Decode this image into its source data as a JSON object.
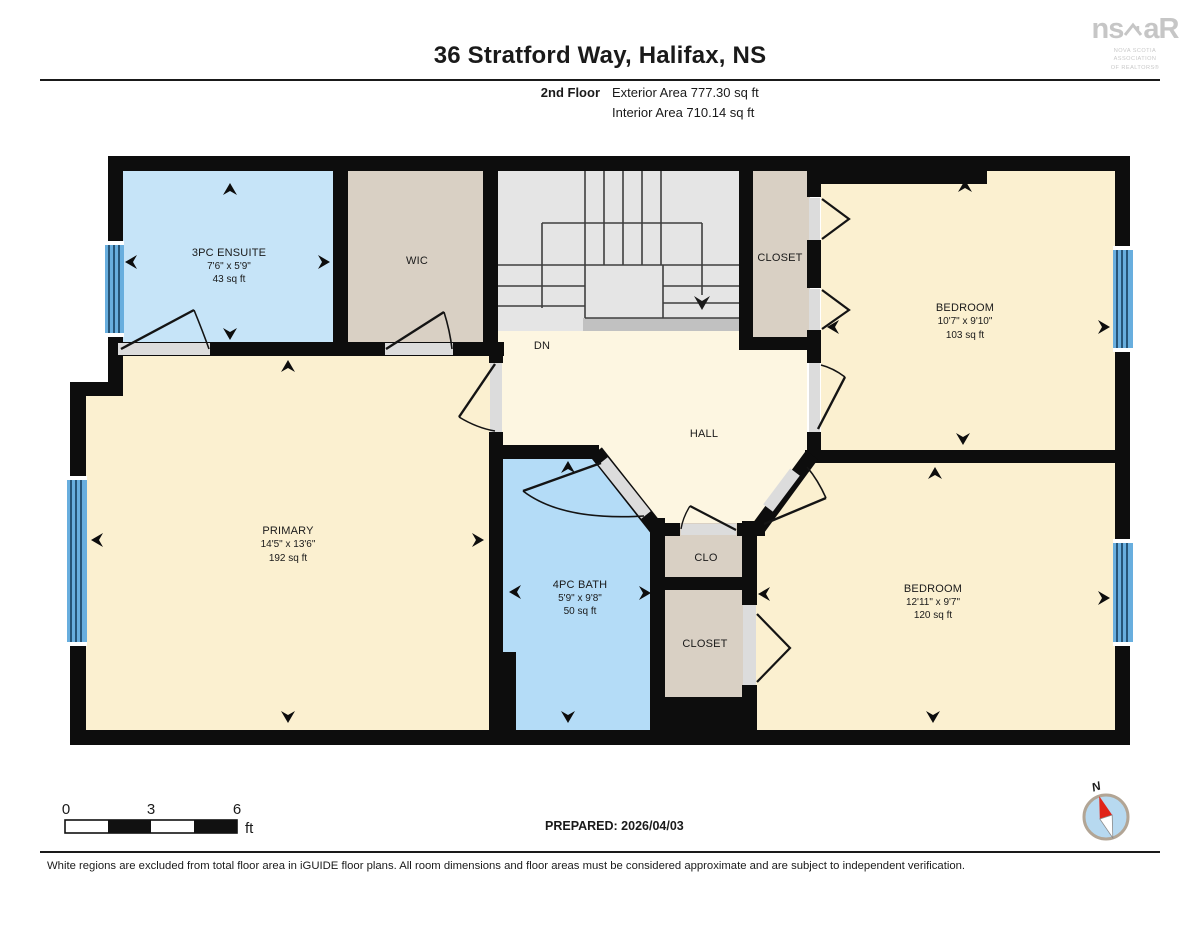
{
  "header": {
    "title": "36 Stratford Way, Halifax, NS",
    "floor_label": "2nd Floor",
    "exterior_area": "Exterior Area 777.30 sq ft",
    "interior_area": "Interior Area 710.14 sq ft"
  },
  "logo": {
    "text_ns": "ns",
    "text_ar": "aR",
    "tagline_line1": "NOVA SCOTIA ASSOCIATION",
    "tagline_line2": "OF REALTORS®"
  },
  "rooms": {
    "ensuite": {
      "name": "3PC ENSUITE",
      "dims": "7'6\" x 5'9\"",
      "area": "43 sq ft"
    },
    "wic": {
      "name": "WIC"
    },
    "stairs": {
      "label": "DN"
    },
    "closet_top": {
      "name": "CLOSET"
    },
    "bedroom_top": {
      "name": "BEDROOM",
      "dims": "10'7\" x 9'10\"",
      "area": "103 sq ft"
    },
    "primary": {
      "name": "PRIMARY",
      "dims": "14'5\" x 13'6\"",
      "area": "192 sq ft"
    },
    "hall": {
      "name": "HALL"
    },
    "bath": {
      "name": "4PC BATH",
      "dims": "5'9\" x 9'8\"",
      "area": "50 sq ft"
    },
    "clo": {
      "name": "CLO"
    },
    "closet_bottom": {
      "name": "CLOSET"
    },
    "bedroom_bottom": {
      "name": "BEDROOM",
      "dims": "12'11\" x 9'7\"",
      "area": "120 sq ft"
    }
  },
  "scale_bar": {
    "tick_0": "0",
    "tick_3": "3",
    "tick_6": "6",
    "unit": "ft"
  },
  "prepared_label": "PREPARED: 2026/04/03",
  "compass": {
    "north_label": "N"
  },
  "footer_note": "White regions are excluded from total floor area in iGUIDE floor plans. All room dimensions and floor areas must be considered approximate and are subject to independent verification.",
  "colors": {
    "wall": "#0d0d0d",
    "bedroom_fill": "#fbf0d0",
    "hall_fill": "#fdf6e1",
    "ensuite_fill": "#c6e4f8",
    "bath_fill": "#b4dcf7",
    "closet_fill": "#d9d0c4",
    "stairs_fill": "#e5e5e5",
    "door_opening": "#dcdcdc",
    "window_blue": "#68aede",
    "compass_red": "#e02419"
  }
}
